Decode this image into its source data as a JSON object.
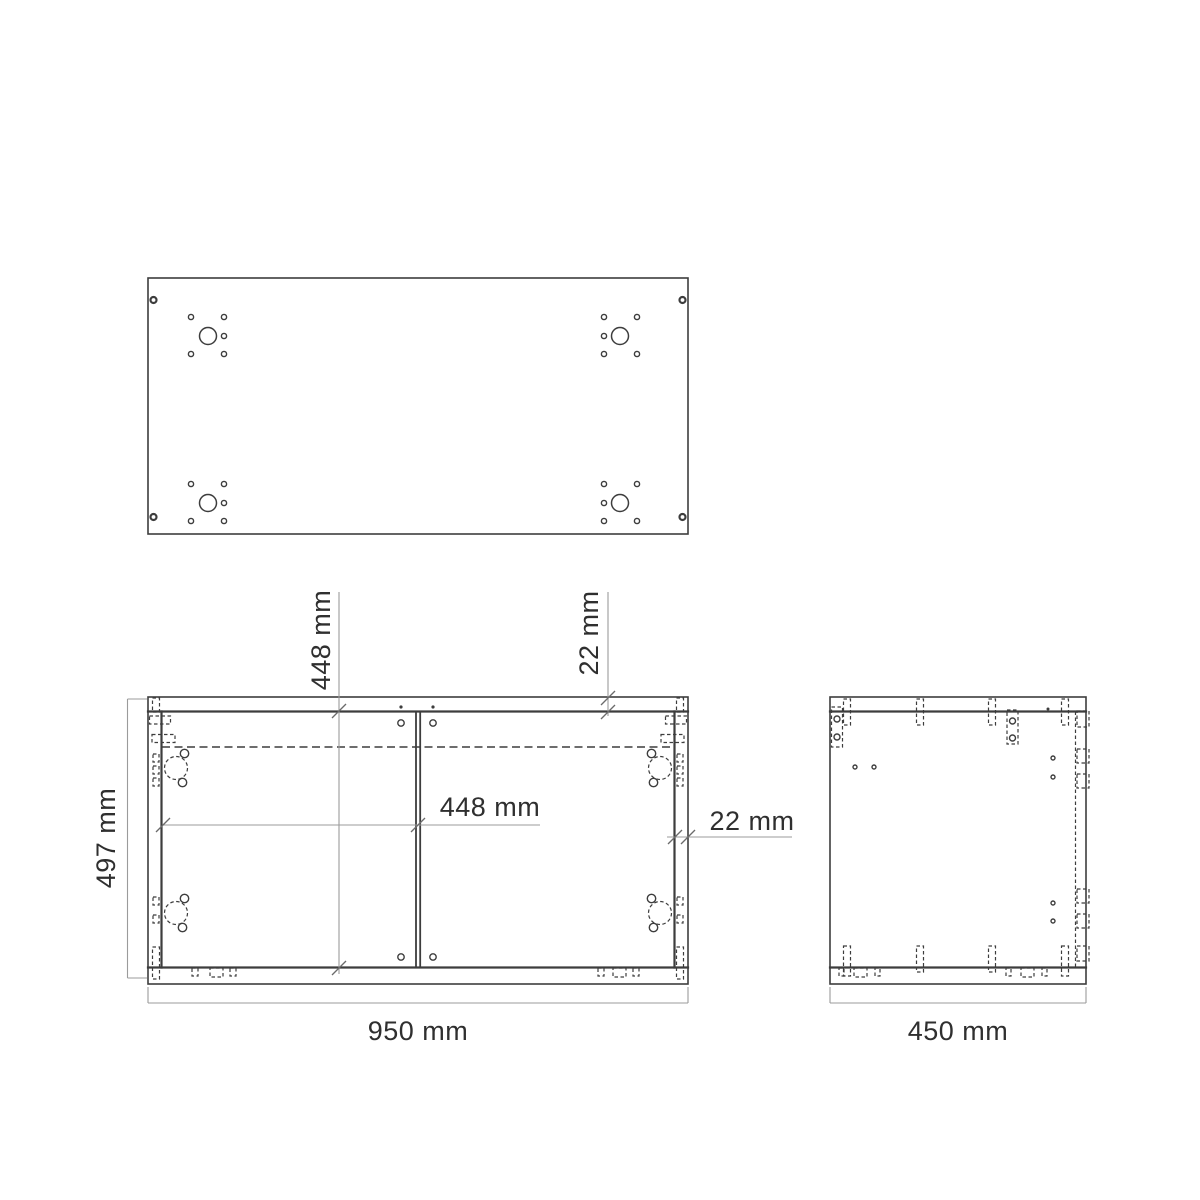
{
  "drawing": {
    "kind": "cabinet technical drawing",
    "views": [
      "top panel plan view",
      "front elevation",
      "side elevation"
    ]
  },
  "colors": {
    "background": "#ffffff",
    "line": "#3d3d3d",
    "dimension_line": "#9b9b9b",
    "text": "#2f2f2f"
  },
  "dimensions": {
    "section_width_top": "448 mm",
    "top_panel_thickness": "22 mm",
    "cabinet_height": "497 mm",
    "section_width": "448 mm",
    "side_panel_thickness": "22 mm",
    "cabinet_width": "950 mm",
    "cabinet_depth": "450 mm"
  }
}
